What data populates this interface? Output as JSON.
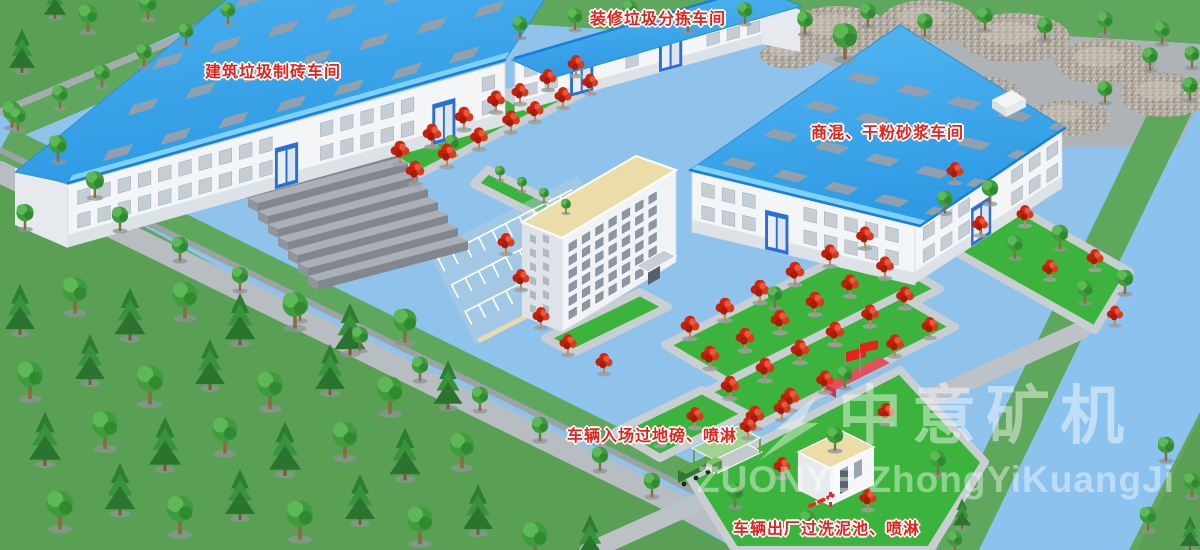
{
  "labels": {
    "sorting_workshop": "装修垃圾分拣车间",
    "brick_workshop": "建筑垃圾制砖车间",
    "mortar_workshop": "商混、干粉砂浆车间",
    "vehicle_entry": "车辆入场过地磅、喷淋",
    "vehicle_exit": "车辆出厂过洗泥池、喷淋"
  },
  "watermark": {
    "cn": "中意矿机",
    "en": "ZUONYE ZhongYiKuangJi"
  },
  "colors": {
    "label_red": "#e8211a",
    "roof_blue": "#38a6ec",
    "roof_blue_light": "#7fd0f5",
    "roof_edge_blue": "#1b7ed8",
    "yard_blue": "#8fc3ec",
    "river_blue": "#8cc3ee",
    "grass_green": "#63a75f",
    "grass_dark": "#59a054",
    "garden_green": "#3cb33c",
    "office_roof_tan": "#ebdca8",
    "wall_white": "#f3f5f7",
    "walkway_gray": "#c9ced2",
    "road_gray": "#b7bdc1"
  }
}
